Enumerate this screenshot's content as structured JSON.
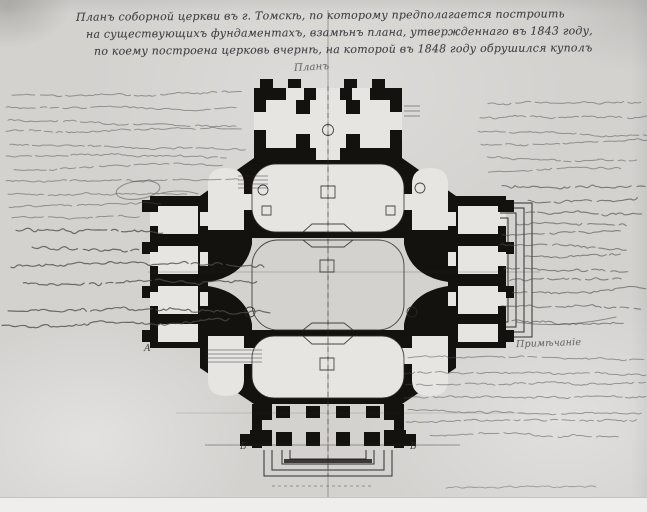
{
  "header": {
    "line1": "Планъ соборной церкви въ г. Томскѣ, по которому предполагается построить",
    "line2": "на существующихъ фундаментахъ, взамѣнъ плана, утвержденнаго въ 1843 году,",
    "line3": "по коему построена церковь вчернѣ, на которой въ 1848 году обрушился куполъ"
  },
  "plan": {
    "label": "Планъ",
    "reference_letters": [
      {
        "text": "А",
        "x": 144,
        "y": 351
      },
      {
        "text": "Б",
        "x": 240,
        "y": 449
      },
      {
        "text": "В",
        "x": 410,
        "y": 449
      }
    ]
  },
  "note": {
    "heading": "Примѣчаніе"
  },
  "colors": {
    "paper": "#d4d2cf",
    "paper_light": "#e7e5e2",
    "ink": "#14120f",
    "ink_line": "#2c2a26",
    "script": "#4e4c49",
    "script_faint": "#73716d",
    "title_ink": "#2f2e33"
  },
  "handwriting": {
    "blocks": [
      {
        "id": "lt",
        "x": 6,
        "y": 95,
        "lh": 12.3,
        "amp": 2,
        "op": 0.5,
        "sw": 1.0,
        "lines": [
          [
            6,
            224
          ],
          [
            0,
            230
          ],
          [
            2,
            226
          ],
          [
            0,
            232
          ],
          [
            4,
            230
          ],
          [
            0,
            218
          ],
          [
            8,
            208
          ],
          [
            0,
            228
          ],
          [
            2,
            178
          ],
          [
            0,
            150
          ],
          [
            6,
            120
          ]
        ]
      },
      {
        "id": "lm",
        "x": 2,
        "y": 231,
        "ys": [
          0,
          15,
          37,
          52,
          79,
          94
        ],
        "amp": 3.4,
        "op": 0.78,
        "sw": 1.2,
        "lines": [
          [
            14,
            142
          ],
          [
            30,
            106
          ],
          [
            4,
            256
          ],
          [
            18,
            232
          ],
          [
            6,
            258
          ],
          [
            0,
            224
          ]
        ]
      },
      {
        "id": "rt",
        "x": 462,
        "y": 103,
        "lh": 13.8,
        "amp": 2.1,
        "op": 0.5,
        "sw": 1.0,
        "lines": [
          [
            26,
            152
          ],
          [
            18,
            166
          ],
          [
            16,
            170
          ],
          [
            14,
            172
          ],
          [
            20,
            152
          ],
          [
            22,
            132
          ]
        ]
      },
      {
        "id": "rs",
        "x": 498,
        "y": 186,
        "ys": [
          0,
          14,
          26
        ],
        "amp": 3.2,
        "op": 0.65,
        "sw": 1.15,
        "lines": [
          [
            4,
            136
          ],
          [
            30,
            106
          ],
          [
            28,
            112
          ]
        ]
      },
      {
        "id": "rc",
        "x": 500,
        "y": 224,
        "ys": [
          0,
          10,
          21,
          32,
          44,
          56,
          68,
          82,
          96
        ],
        "amp": 2.6,
        "op": 0.6,
        "sw": 1.1,
        "lines": [
          [
            16,
            100
          ],
          [
            2,
            116
          ],
          [
            0,
            126
          ],
          [
            24,
            92
          ],
          [
            4,
            122
          ],
          [
            10,
            108
          ],
          [
            8,
            136
          ],
          [
            2,
            132
          ],
          [
            12,
            110
          ]
        ]
      },
      {
        "id": "note",
        "x": 404,
        "y": 357,
        "ys": [
          0,
          16,
          28,
          40,
          52,
          65,
          78
        ],
        "amp": 2,
        "op": 0.5,
        "sw": 1.0,
        "lines": [
          [
            4,
            232
          ],
          [
            0,
            238
          ],
          [
            2,
            234
          ],
          [
            0,
            236
          ],
          [
            4,
            228
          ],
          [
            2,
            230
          ],
          [
            26,
            180
          ]
        ]
      },
      {
        "id": "cap",
        "x": 446,
        "y": 488,
        "lh": 0,
        "amp": 1.6,
        "op": 0.45,
        "sw": 0.9,
        "lines": [
          [
            0,
            146
          ]
        ]
      }
    ]
  }
}
